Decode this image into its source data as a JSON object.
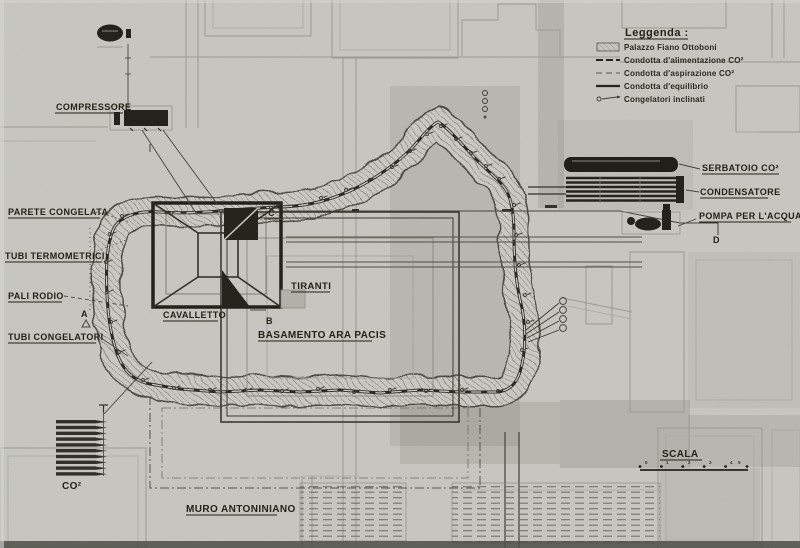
{
  "colors": {
    "paper": "#c8c7c1",
    "ink": "#24231d",
    "faint_plan": "#9c9b92",
    "shade": "#8f8e86"
  },
  "labels": {
    "compressore": "COMPRESSORE",
    "parete_congelata": "PARETE CONGELATA",
    "tubi_termometrici": "TUBI TERMOMETRICI",
    "pali_rodio": "PALI RODIO",
    "tubi_congelatori": "TUBI CONGELATORI",
    "cavalletto": "CAVALLETTO",
    "tiranti": "TIRANTI",
    "basamento": "BASAMENTO ARA PACIS",
    "muro_antoniniano": "MURO ANTONINIANO",
    "co2": "CO²",
    "serbatoio": "SERBATOIO CO²",
    "condensatore": "CONDENSATORE",
    "pompa": "POMPA PER L'ACQUA"
  },
  "section_markers": {
    "a": "A",
    "b": "B",
    "c": "C",
    "d": "D"
  },
  "legend": {
    "title": "Leggenda :",
    "items": [
      {
        "label": "Palazzo Fiano Ottoboni",
        "swatch": "hatched-rect"
      },
      {
        "label": "Condotta d'alimentazione CO²",
        "swatch": "heavy-dashed-line"
      },
      {
        "label": "Condotta d'aspirazione CO²",
        "swatch": "light-dashed-line"
      },
      {
        "label": "Condotta d'equilibrio",
        "swatch": "solid-line"
      },
      {
        "label": "Congelatori inclinati",
        "swatch": "circle-arrow"
      }
    ]
  },
  "scale": {
    "label": "SCALA",
    "ticks": [
      "0",
      "1",
      "2",
      "3",
      "4",
      "5"
    ]
  }
}
